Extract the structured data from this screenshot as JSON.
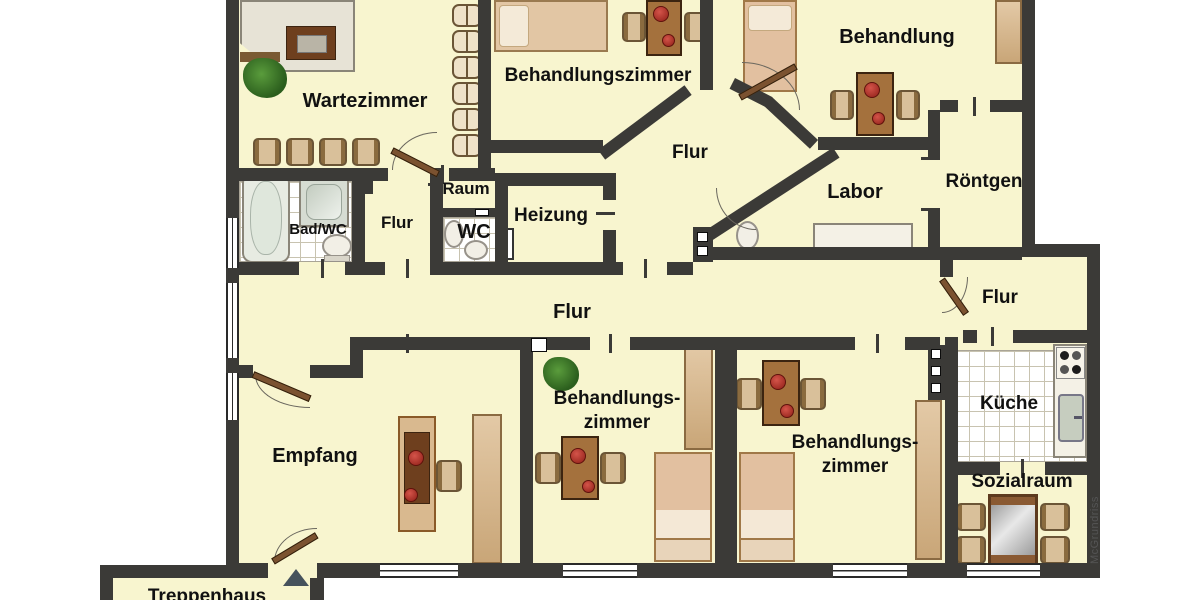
{
  "rooms": {
    "wartezimmer": {
      "label": "Wartezimmer"
    },
    "behandlungszimmer_top": {
      "label": "Behandlungszimmer"
    },
    "behandlung": {
      "label": "Behandlung"
    },
    "flur_top": {
      "label": "Flur"
    },
    "raum": {
      "label": "Raum"
    },
    "bad_wc": {
      "label": "Bad/WC"
    },
    "flur_left": {
      "label": "Flur"
    },
    "wc": {
      "label": "WC"
    },
    "heizung": {
      "label": "Heizung"
    },
    "labor": {
      "label": "Labor"
    },
    "roentgen": {
      "label": "Röntgen"
    },
    "flur_main": {
      "label": "Flur"
    },
    "flur_right": {
      "label": "Flur"
    },
    "empfang": {
      "label": "Empfang"
    },
    "behandlungszimmer_mid": {
      "line1": "Behandlungs-",
      "line2": "zimmer"
    },
    "behandlungszimmer_right": {
      "line1": "Behandlungs-",
      "line2": "zimmer"
    },
    "kueche": {
      "label": "Küche"
    },
    "sozialraum": {
      "label": "Sozialraum"
    },
    "treppenhaus": {
      "label": "Treppenhaus"
    }
  },
  "watermark": {
    "credit": "McGrundriss"
  },
  "palette": {
    "floor": "#f8f5cf",
    "wall": "#3b3a37",
    "tile": "#ffffff",
    "furniture_wood": "#a4713d",
    "furniture_beige": "#d9bd99",
    "chair_red": "#b5342e",
    "plant_green": "#3f7d2c"
  }
}
